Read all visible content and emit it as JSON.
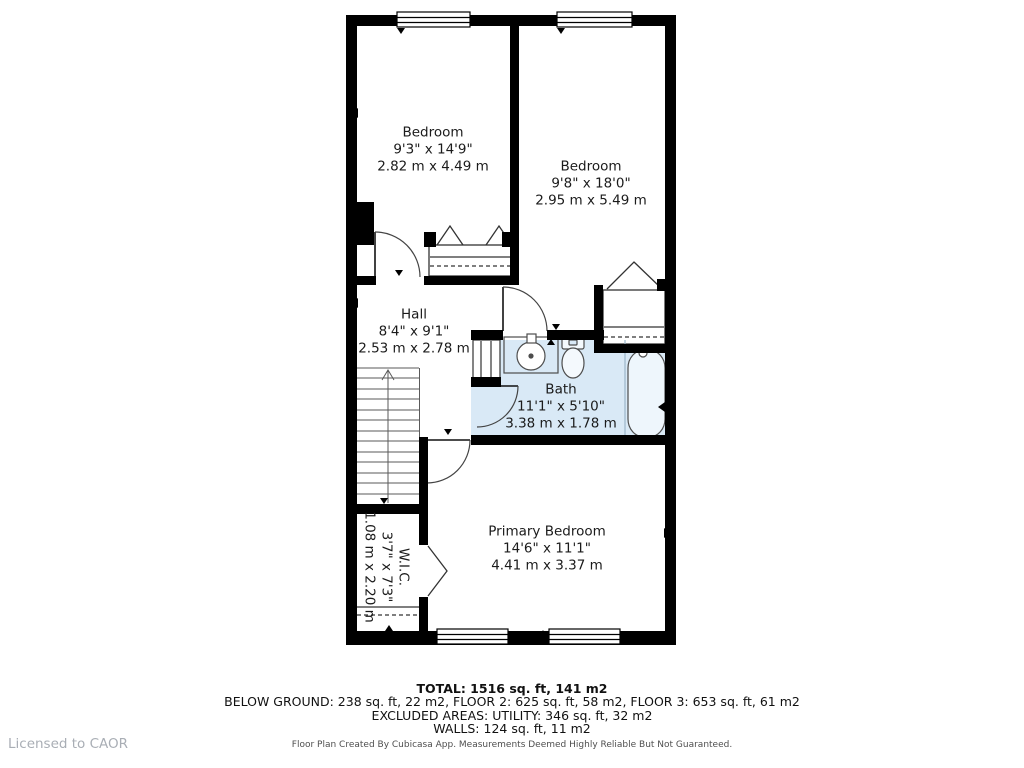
{
  "rooms": {
    "bedroom1": {
      "name": "Bedroom",
      "imperial": "9'3\" x 14'9\"",
      "metric": "2.82 m x 4.49 m"
    },
    "bedroom2": {
      "name": "Bedroom",
      "imperial": "9'8\" x 18'0\"",
      "metric": "2.95 m x 5.49 m"
    },
    "hall": {
      "name": "Hall",
      "imperial": "8'4\" x 9'1\"",
      "metric": "2.53 m x 2.78 m"
    },
    "bath": {
      "name": "Bath",
      "imperial": "11'1\" x 5'10\"",
      "metric": "3.38 m x 1.78 m"
    },
    "primary": {
      "name": "Primary Bedroom",
      "imperial": "14'6\" x 11'1\"",
      "metric": "4.41 m x 3.37 m"
    },
    "wic": {
      "name": "W.I.C.",
      "imperial": "3'7\" x 7'3\"",
      "metric": "1.08 m x 2.20 m"
    }
  },
  "summary": {
    "total": "TOTAL: 1516 sq. ft, 141 m2",
    "floors": "BELOW GROUND: 238 sq. ft, 22 m2, FLOOR 2: 625 sq. ft, 58 m2, FLOOR 3: 653 sq. ft, 61 m2",
    "excluded": "EXCLUDED AREAS: UTILITY: 346 sq. ft, 32 m2",
    "walls": "WALLS: 124 sq. ft, 11 m2",
    "disclaimer": "Floor Plan Created By Cubicasa App. Measurements Deemed Highly Reliable But Not Guaranteed."
  },
  "branding": {
    "licensed_to": "Licensed to CAOR"
  },
  "colors": {
    "wall": "#000000",
    "bath_fill": "#d9e9f6",
    "fixture_stroke": "#4d4d4d",
    "license_text": "#a9aeb5"
  }
}
